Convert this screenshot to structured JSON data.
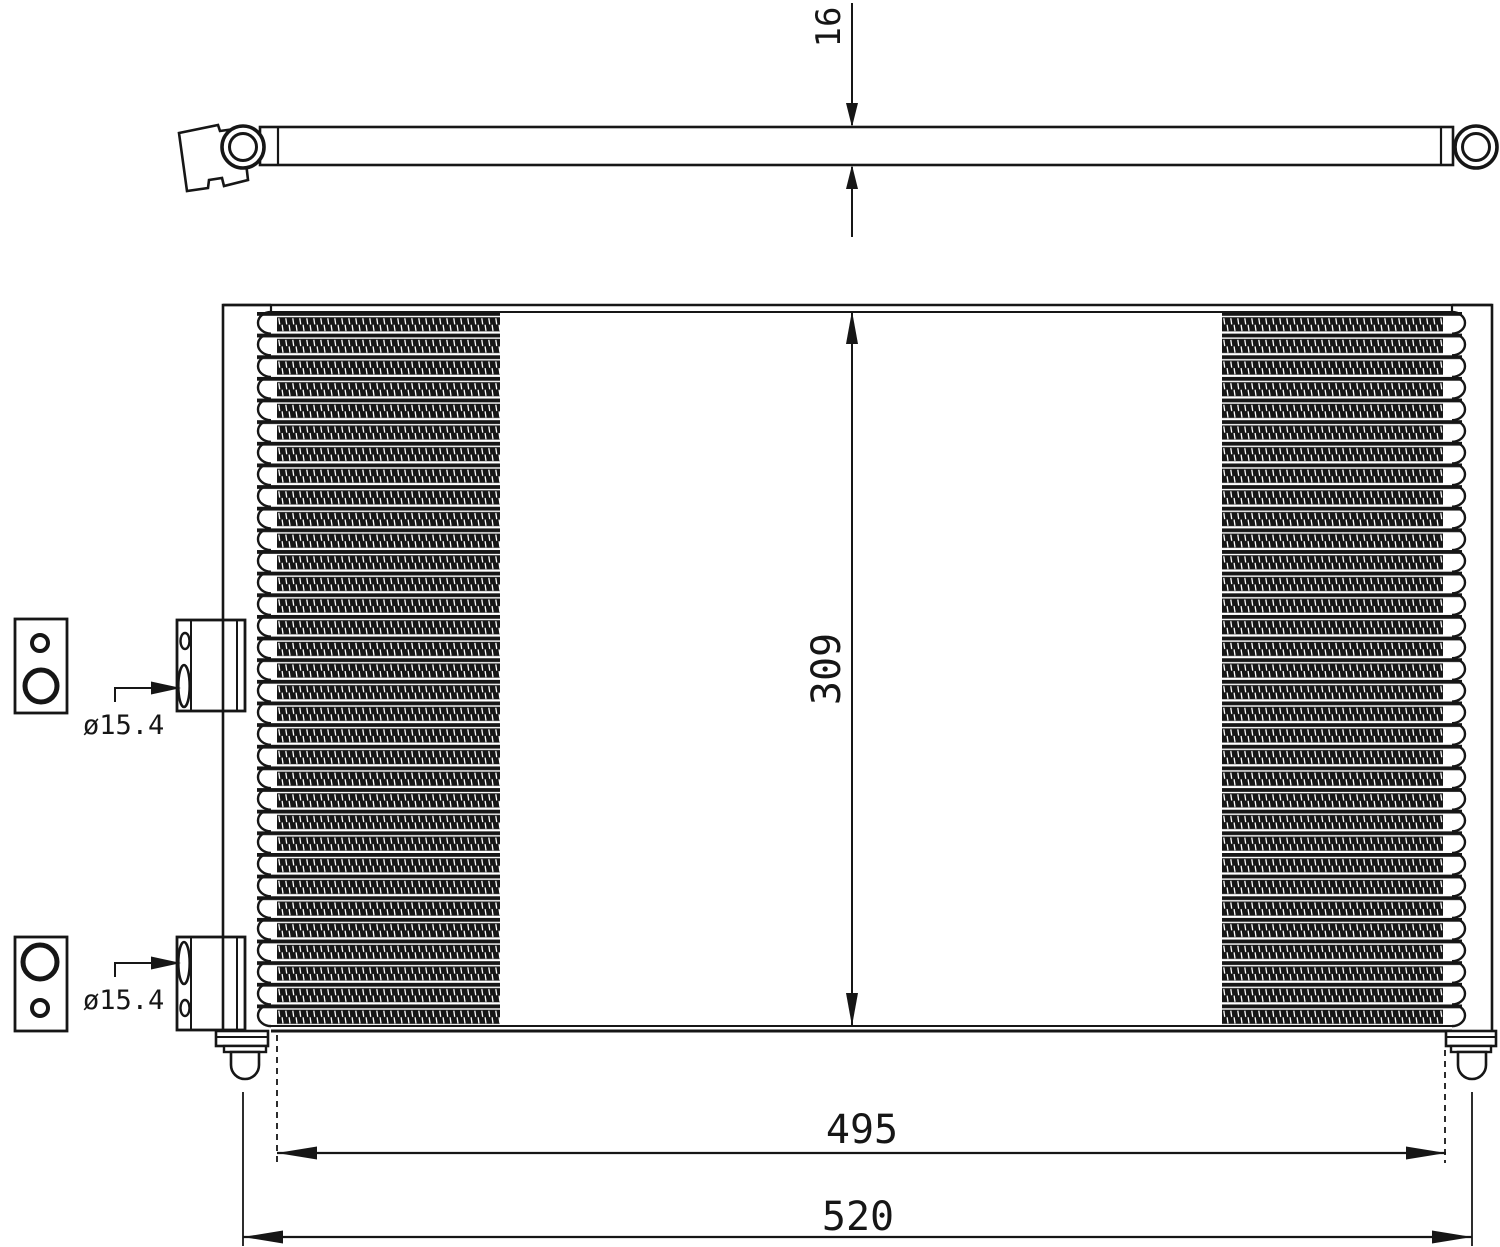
{
  "drawing": {
    "background": "#ffffff",
    "line_color": "#161616",
    "labels": {
      "thickness": "16",
      "core_height": "309",
      "core_width": "495",
      "overall_width": "520",
      "upper_port_diameter": "ø15.4",
      "lower_port_diameter": "ø15.4"
    }
  }
}
